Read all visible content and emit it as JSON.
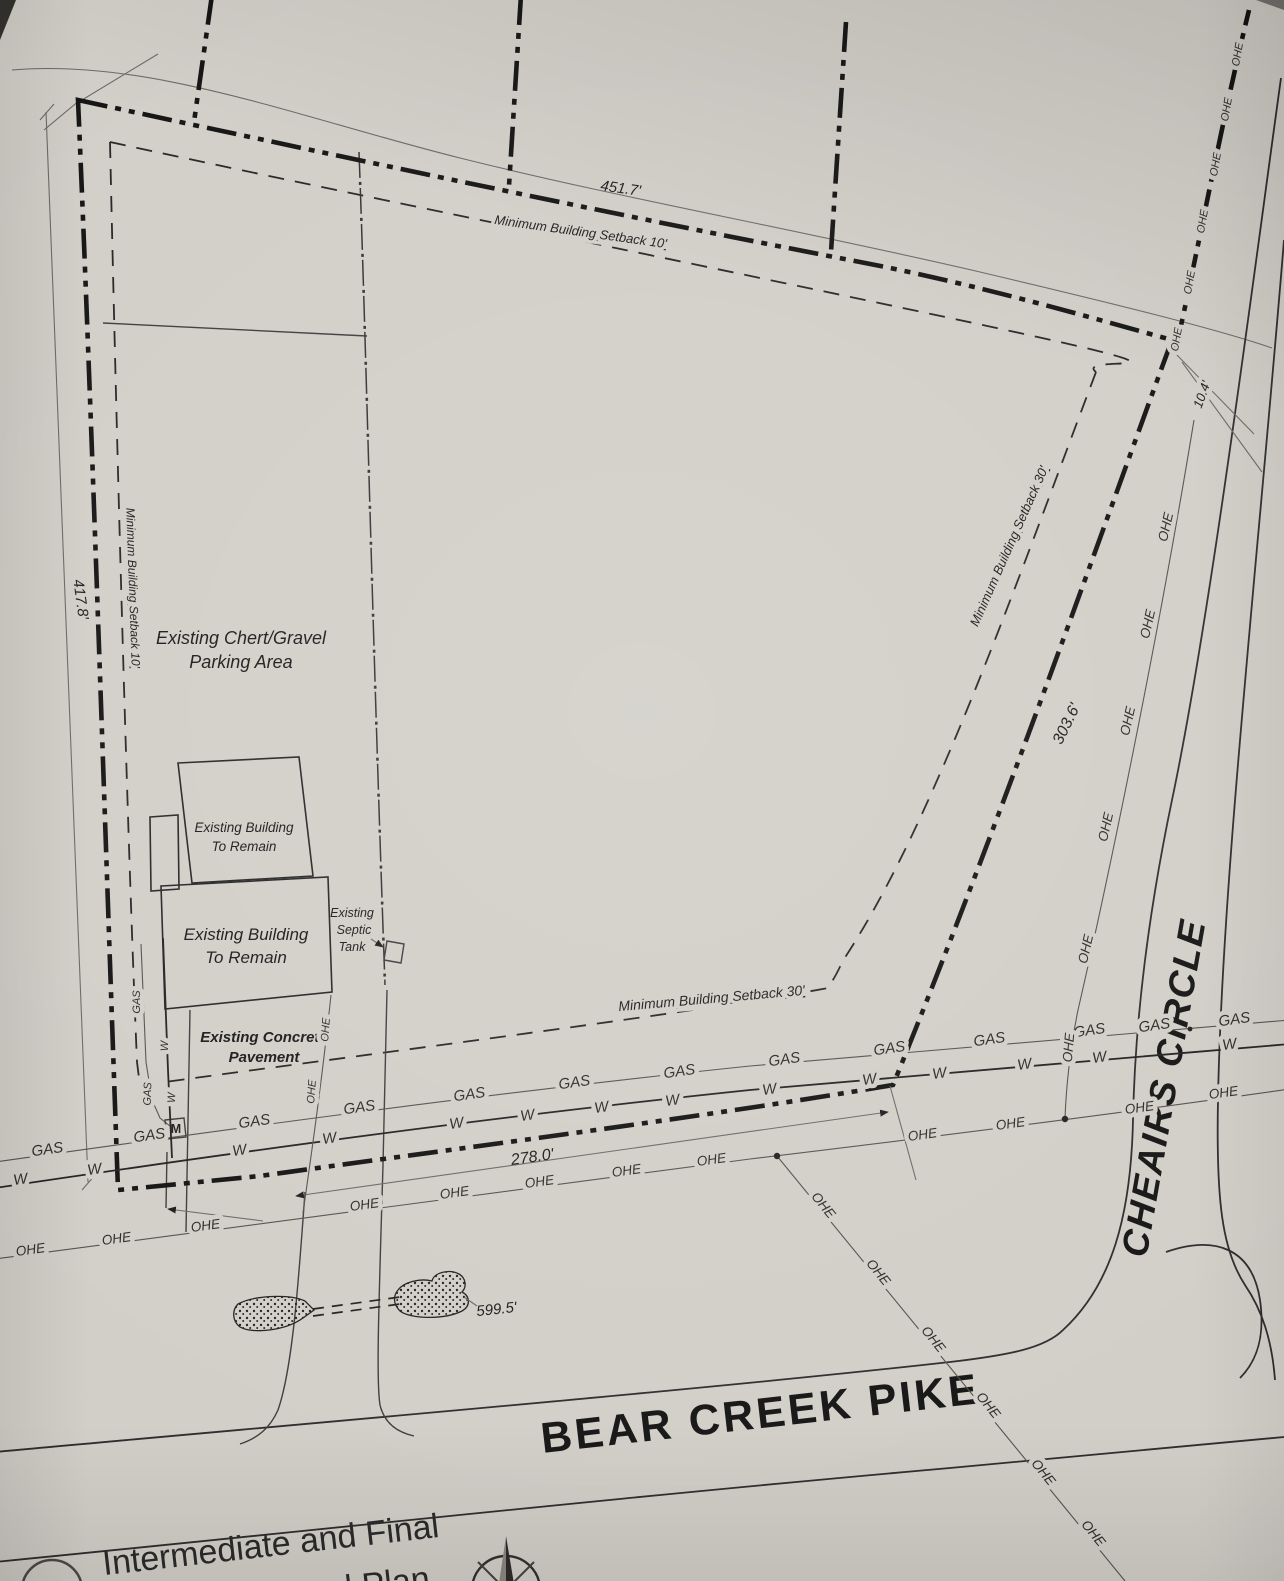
{
  "plan": {
    "areas": {
      "parking1": "Existing Chert/Gravel",
      "parking2": "Parking Area",
      "bldg1": "Existing Building",
      "bldg2": "To Remain",
      "pave1": "Existing Concrete",
      "pave2": "Pavement",
      "septic1": "Existing",
      "septic2": "Septic",
      "septic3": "Tank"
    },
    "setbacks": {
      "ten": "Minimum Building Setback 10'",
      "thirty": "Minimum Building Setback 30'"
    },
    "dims": {
      "north": "451.7'",
      "west": "417.8'",
      "east": "303.6'",
      "corner": "10.4'",
      "frontage": "278.0'",
      "drive": "599.5'"
    },
    "roads": {
      "cheairs": "CHEAIRS CIRCLE",
      "bear_creek": "BEAR CREEK PIKE"
    },
    "util": {
      "gas": "GAS",
      "w": "W",
      "ohe": "OHE",
      "meter": "M"
    },
    "title": {
      "line1": "Intermediate and Final",
      "line2": "Control Plan"
    }
  },
  "colors": {
    "paper": "#d2cfc8",
    "ink": "#1f1f1f"
  }
}
